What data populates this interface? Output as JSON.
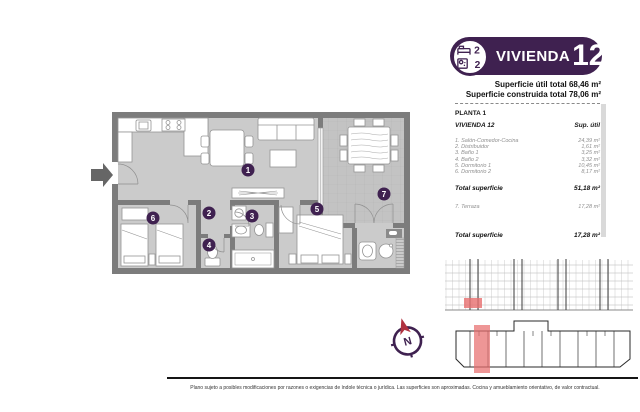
{
  "badge": {
    "title": "VIVIENDA",
    "number": "12",
    "bedrooms": "2",
    "bathrooms": "2"
  },
  "totals_header": {
    "util": "Superficie útil total 68,46 m²",
    "construida": "Superficie construida total 78,06 m²"
  },
  "table": {
    "floor_label": "PLANTA 1",
    "unit_label": "VIVIENDA 12",
    "col_header": "Sup. útil",
    "rows": [
      {
        "label": "1. Salón-Comedor-Cocina",
        "value": "24,39 m²"
      },
      {
        "label": "2. Distribuidor",
        "value": "1,61 m²"
      },
      {
        "label": "3. Baño 1",
        "value": "3,25 m²"
      },
      {
        "label": "4. Baño 2",
        "value": "3,32 m²"
      },
      {
        "label": "5. Dormitorio 1",
        "value": "10,45 m²"
      },
      {
        "label": "6. Dormitorio 2",
        "value": "8,17 m²"
      }
    ],
    "total_interior": {
      "label": "Total superficie",
      "value": "51,18 m²"
    },
    "terrace_row": {
      "label": "7. Terraza",
      "value": "17,28 m²"
    },
    "total_terrace": {
      "label": "Total superficie",
      "value": "17,28 m²"
    }
  },
  "plan": {
    "rooms": [
      "1",
      "2",
      "3",
      "4",
      "5",
      "6",
      "7"
    ],
    "compass_label": "N"
  },
  "footer": {
    "disclaimer": "Plano sujeto a posibles modificaciones por razones o exigencias de índole técnica o jurídica. Las superficies son aproximadas. Cocina y amueblamiento orientativo, de valor contractual."
  },
  "colors": {
    "brand_purple": "#3F2150",
    "unit_highlight_red": "#E76E6E",
    "compass_arrow_red": "#B03240",
    "wall_gray": "#7C7C7C",
    "floor_gray": "#CBCBCB"
  }
}
